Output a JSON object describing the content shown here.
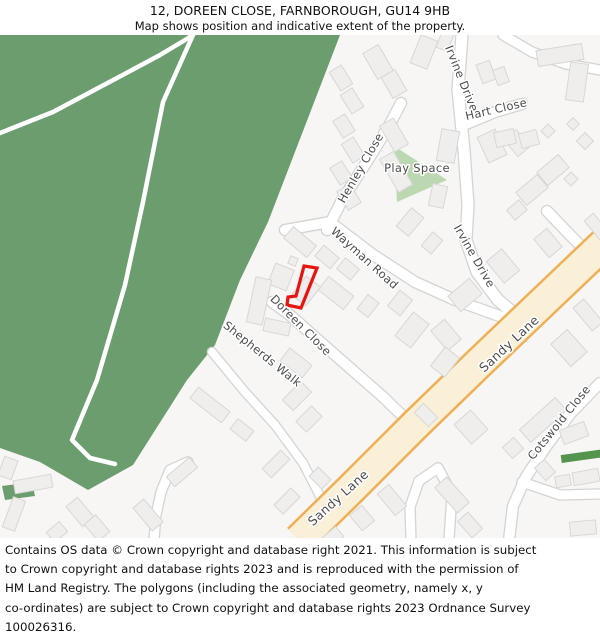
{
  "header": {
    "title": "12, DOREEN CLOSE, FARNBOROUGH, GU14 9HB",
    "subtitle": "Map shows position and indicative extent of the property."
  },
  "map": {
    "colors": {
      "background": "#f7f6f4",
      "woodland": "#6b9d6f",
      "play_space": "#bcd8b2",
      "green_strip": "#55944f",
      "path": "#ffffff",
      "road_fill": "#ffffff",
      "road_casing": "#d6d4d1",
      "sandy_fill": "#faf0d8",
      "sandy_casing": "#efaf55",
      "building_fill": "#efeeec",
      "building_stroke": "#d9d7d4",
      "label": "#4d4d4d",
      "property_outline": "#e81410"
    },
    "woodland": [
      [
        [
          0,
          35
        ],
        [
          340,
          35
        ],
        [
          268,
          222
        ],
        [
          240,
          280
        ],
        [
          215,
          345
        ],
        [
          187,
          380
        ],
        [
          133,
          465
        ],
        [
          88,
          490
        ],
        [
          40,
          462
        ],
        [
          0,
          448
        ]
      ],
      [
        [
          2,
          486
        ],
        [
          32,
          482
        ],
        [
          35,
          496
        ],
        [
          5,
          500
        ]
      ]
    ],
    "forest_paths": [
      [
        [
          0,
          133
        ],
        [
          53,
          112
        ],
        [
          117,
          78
        ],
        [
          160,
          55
        ],
        [
          185,
          40
        ],
        [
          193,
          35
        ]
      ],
      [
        [
          193,
          35
        ],
        [
          163,
          102
        ],
        [
          143,
          202
        ],
        [
          125,
          285
        ],
        [
          97,
          380
        ],
        [
          72,
          440
        ],
        [
          90,
          458
        ],
        [
          115,
          464
        ]
      ]
    ],
    "play_space": {
      "points": [
        [
          394,
          146
        ],
        [
          447,
          180
        ],
        [
          397,
          202
        ]
      ]
    },
    "roads": [
      {
        "name": "irvine-drive",
        "pts": [
          [
            462,
            35
          ],
          [
            458,
            90
          ],
          [
            464,
            150
          ],
          [
            468,
            205
          ],
          [
            466,
            240
          ],
          [
            477,
            272
          ],
          [
            498,
            300
          ],
          [
            516,
            315
          ]
        ],
        "w": 11
      },
      {
        "name": "hart-close",
        "pts": [
          [
            466,
            124
          ],
          [
            495,
            112
          ],
          [
            522,
            104
          ]
        ],
        "w": 10
      },
      {
        "name": "henley-close",
        "pts": [
          [
            327,
            230
          ],
          [
            342,
            200
          ],
          [
            368,
            160
          ],
          [
            390,
            124
          ],
          [
            401,
            103
          ]
        ],
        "w": 10
      },
      {
        "name": "wayman-road",
        "pts": [
          [
            285,
            230
          ],
          [
            330,
            222
          ],
          [
            372,
            254
          ],
          [
            415,
            282
          ],
          [
            455,
            300
          ],
          [
            505,
            318
          ]
        ],
        "w": 10
      },
      {
        "name": "doreen-close",
        "pts": [
          [
            272,
            302
          ],
          [
            290,
            315
          ],
          [
            318,
            340
          ],
          [
            350,
            368
          ],
          [
            382,
            396
          ],
          [
            412,
            425
          ]
        ],
        "w": 10
      },
      {
        "name": "shepherds-walk",
        "pts": [
          [
            212,
            352
          ],
          [
            245,
            392
          ],
          [
            275,
            425
          ],
          [
            303,
            463
          ],
          [
            322,
            500
          ],
          [
            330,
            520
          ]
        ],
        "w": 8
      },
      {
        "name": "access-road-west",
        "pts": [
          [
            188,
            462
          ],
          [
            170,
            470
          ],
          [
            161,
            492
          ],
          [
            156,
            515
          ],
          [
            154,
            540
          ]
        ],
        "w": 9
      },
      {
        "name": "access-road-center",
        "pts": [
          [
            438,
            468
          ],
          [
            419,
            481
          ],
          [
            410,
            507
          ],
          [
            411,
            540
          ]
        ],
        "w": 9
      },
      {
        "name": "access-road-center-2",
        "pts": [
          [
            438,
            468
          ],
          [
            452,
            494
          ],
          [
            449,
            540
          ]
        ],
        "w": 9
      },
      {
        "name": "cotswold-close",
        "pts": [
          [
            600,
            383
          ],
          [
            570,
            414
          ],
          [
            545,
            448
          ],
          [
            526,
            477
          ],
          [
            513,
            506
          ],
          [
            509,
            540
          ]
        ],
        "w": 10
      },
      {
        "name": "cotswold-close-spur",
        "pts": [
          [
            522,
            482
          ],
          [
            560,
            495
          ],
          [
            600,
            494
          ]
        ],
        "w": 9
      },
      {
        "name": "road-top-right",
        "pts": [
          [
            503,
            35
          ],
          [
            532,
            52
          ],
          [
            566,
            64
          ],
          [
            600,
            70
          ]
        ],
        "w": 9
      },
      {
        "name": "cul-de-sac-east",
        "pts": [
          [
            547,
            211
          ],
          [
            570,
            235
          ],
          [
            592,
            257
          ],
          [
            600,
            266
          ]
        ],
        "w": 10
      }
    ],
    "sandy_lane": {
      "name": "sandy-lane",
      "pts": [
        [
          608,
          240
        ],
        [
          545,
          300
        ],
        [
          480,
          362
        ],
        [
          415,
          425
        ],
        [
          352,
          488
        ],
        [
          299,
          540
        ]
      ],
      "w": 29,
      "casing_w": 34
    },
    "buildings": [
      [
        341,
        78,
        14,
        22,
        -32
      ],
      [
        352,
        101,
        14,
        22,
        -32
      ],
      [
        344,
        126,
        14,
        20,
        -32
      ],
      [
        353,
        150,
        14,
        22,
        -32
      ],
      [
        341,
        173,
        14,
        20,
        -32
      ],
      [
        349,
        197,
        15,
        22,
        -32
      ],
      [
        378,
        62,
        18,
        30,
        -30
      ],
      [
        394,
        84,
        16,
        24,
        -30
      ],
      [
        394,
        135,
        16,
        30,
        -30
      ],
      [
        396,
        172,
        16,
        38,
        -30
      ],
      [
        424,
        52,
        18,
        30,
        22
      ],
      [
        445,
        41,
        12,
        18,
        22
      ],
      [
        448,
        146,
        18,
        32,
        10
      ],
      [
        438,
        196,
        15,
        22,
        12
      ],
      [
        492,
        146,
        20,
        28,
        -25
      ],
      [
        517,
        143,
        16,
        22,
        -40
      ],
      [
        486,
        72,
        14,
        20,
        -20
      ],
      [
        501,
        76,
        12,
        16,
        -20
      ],
      [
        577,
        82,
        18,
        38,
        8
      ],
      [
        560,
        55,
        46,
        16,
        -9
      ],
      [
        548,
        131,
        10,
        10,
        45
      ],
      [
        573,
        124,
        9,
        9,
        45
      ],
      [
        585,
        141,
        12,
        12,
        45
      ],
      [
        505,
        138,
        20,
        15,
        -12
      ],
      [
        529,
        139,
        18,
        15,
        -15
      ],
      [
        553,
        170,
        28,
        17,
        -40
      ],
      [
        532,
        190,
        28,
        17,
        -40
      ],
      [
        517,
        210,
        16,
        13,
        -40
      ],
      [
        571,
        179,
        10,
        10,
        45
      ],
      [
        597,
        227,
        12,
        26,
        -40
      ],
      [
        548,
        243,
        17,
        24,
        -40
      ],
      [
        588,
        315,
        14,
        30,
        -40
      ],
      [
        503,
        266,
        20,
        28,
        -40
      ],
      [
        465,
        295,
        28,
        20,
        -40
      ],
      [
        446,
        335,
        18,
        26,
        -40
      ],
      [
        410,
        222,
        16,
        24,
        40
      ],
      [
        432,
        243,
        13,
        18,
        40
      ],
      [
        300,
        242,
        30,
        15,
        40
      ],
      [
        327,
        257,
        20,
        14,
        40
      ],
      [
        348,
        269,
        18,
        14,
        40
      ],
      [
        281,
        277,
        20,
        22,
        22
      ],
      [
        293,
        261,
        8,
        8,
        22
      ],
      [
        336,
        293,
        32,
        17,
        38
      ],
      [
        368,
        306,
        14,
        18,
        38
      ],
      [
        306,
        291,
        18,
        24,
        38
      ],
      [
        400,
        303,
        16,
        20,
        38
      ],
      [
        259,
        301,
        16,
        46,
        12
      ],
      [
        277,
        327,
        26,
        13,
        12
      ],
      [
        296,
        363,
        28,
        16,
        38
      ],
      [
        412,
        330,
        20,
        30,
        38
      ],
      [
        445,
        362,
        18,
        24,
        38
      ],
      [
        210,
        405,
        40,
        14,
        38
      ],
      [
        242,
        430,
        20,
        13,
        38
      ],
      [
        33,
        484,
        38,
        13,
        -10
      ],
      [
        8,
        468,
        14,
        20,
        20
      ],
      [
        14,
        514,
        13,
        32,
        20
      ],
      [
        80,
        512,
        15,
        26,
        -40
      ],
      [
        97,
        528,
        15,
        22,
        -40
      ],
      [
        57,
        532,
        17,
        13,
        -40
      ],
      [
        182,
        472,
        30,
        13,
        -40
      ],
      [
        148,
        515,
        14,
        30,
        -40
      ],
      [
        297,
        396,
        15,
        26,
        45
      ],
      [
        309,
        419,
        15,
        22,
        45
      ],
      [
        276,
        464,
        13,
        26,
        45
      ],
      [
        287,
        501,
        13,
        24,
        45
      ],
      [
        320,
        478,
        18,
        13,
        45
      ],
      [
        332,
        538,
        20,
        13,
        -40
      ],
      [
        362,
        518,
        16,
        20,
        -40
      ],
      [
        392,
        500,
        15,
        28,
        -40
      ],
      [
        543,
        420,
        48,
        17,
        -42
      ],
      [
        471,
        427,
        22,
        26,
        -42
      ],
      [
        426,
        415,
        20,
        13,
        45
      ],
      [
        513,
        448,
        15,
        15,
        -42
      ],
      [
        569,
        348,
        22,
        30,
        -42
      ],
      [
        452,
        495,
        16,
        34,
        -42
      ],
      [
        470,
        525,
        14,
        22,
        -42
      ],
      [
        545,
        470,
        13,
        17,
        -42
      ],
      [
        574,
        433,
        26,
        15,
        -20
      ],
      [
        586,
        477,
        26,
        13,
        -10
      ],
      [
        563,
        481,
        15,
        11,
        -10
      ],
      [
        583,
        528,
        26,
        14,
        -5
      ]
    ],
    "greens": [
      {
        "cx": 583,
        "cy": 456,
        "w": 44,
        "h": 8,
        "rot": -8,
        "color": "#55944f"
      }
    ],
    "property": {
      "points": [
        [
          304,
          266
        ],
        [
          317,
          268
        ],
        [
          301,
          308
        ],
        [
          287,
          305
        ],
        [
          288,
          297
        ],
        [
          296,
          296
        ]
      ]
    },
    "street_labels": [
      {
        "text": "Henley Close",
        "x": 364,
        "y": 170,
        "rot": -60
      },
      {
        "text": "Irvine Drive",
        "x": 458,
        "y": 80,
        "rot": 68
      },
      {
        "text": "Hart Close",
        "x": 497,
        "y": 113,
        "rot": -13
      },
      {
        "text": "Play Space",
        "x": 417,
        "y": 172,
        "rot": 0
      },
      {
        "text": "Wayman Road",
        "x": 362,
        "y": 261,
        "rot": 42
      },
      {
        "text": "Irvine Drive",
        "x": 471,
        "y": 258,
        "rot": 60
      },
      {
        "text": "Doreen Close",
        "x": 298,
        "y": 328,
        "rot": 45
      },
      {
        "text": "Shepherds Walk",
        "x": 260,
        "y": 357,
        "rot": 39
      },
      {
        "text": "Sandy Lane",
        "x": 512,
        "y": 347,
        "rot": -43,
        "size": 12.5
      },
      {
        "text": "Sandy Lane",
        "x": 341,
        "y": 501,
        "rot": -42,
        "size": 12.5
      },
      {
        "text": "Cotswold Close",
        "x": 562,
        "y": 425,
        "rot": -51
      }
    ]
  },
  "footer": {
    "lines": [
      "Contains OS data © Crown copyright and database right 2021. This information is subject",
      "to Crown copyright and database rights 2023 and is reproduced with the permission of",
      "HM Land Registry. The polygons (including the associated geometry, namely x, y",
      "co-ordinates) are subject to Crown copyright and database rights 2023 Ordnance Survey",
      "100026316."
    ]
  }
}
